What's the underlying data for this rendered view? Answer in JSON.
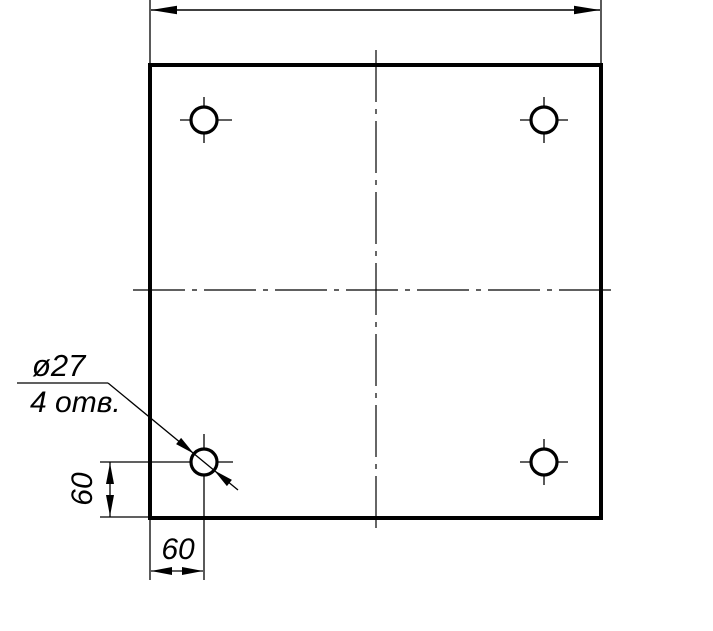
{
  "drawing": {
    "kind": "engineering-drawing-plate-top-view",
    "background_color": "#ffffff",
    "line_color": "#000000",
    "labels": {
      "hole_diameter": "ø27",
      "hole_count": "4 отв.",
      "dim_vertical_offset": "60",
      "dim_horizontal_offset": "60"
    },
    "features": {
      "holes_total": 4,
      "hole_diameter_value": 27,
      "hole_offset_from_left": 60,
      "hole_offset_from_bottom": 60
    }
  }
}
